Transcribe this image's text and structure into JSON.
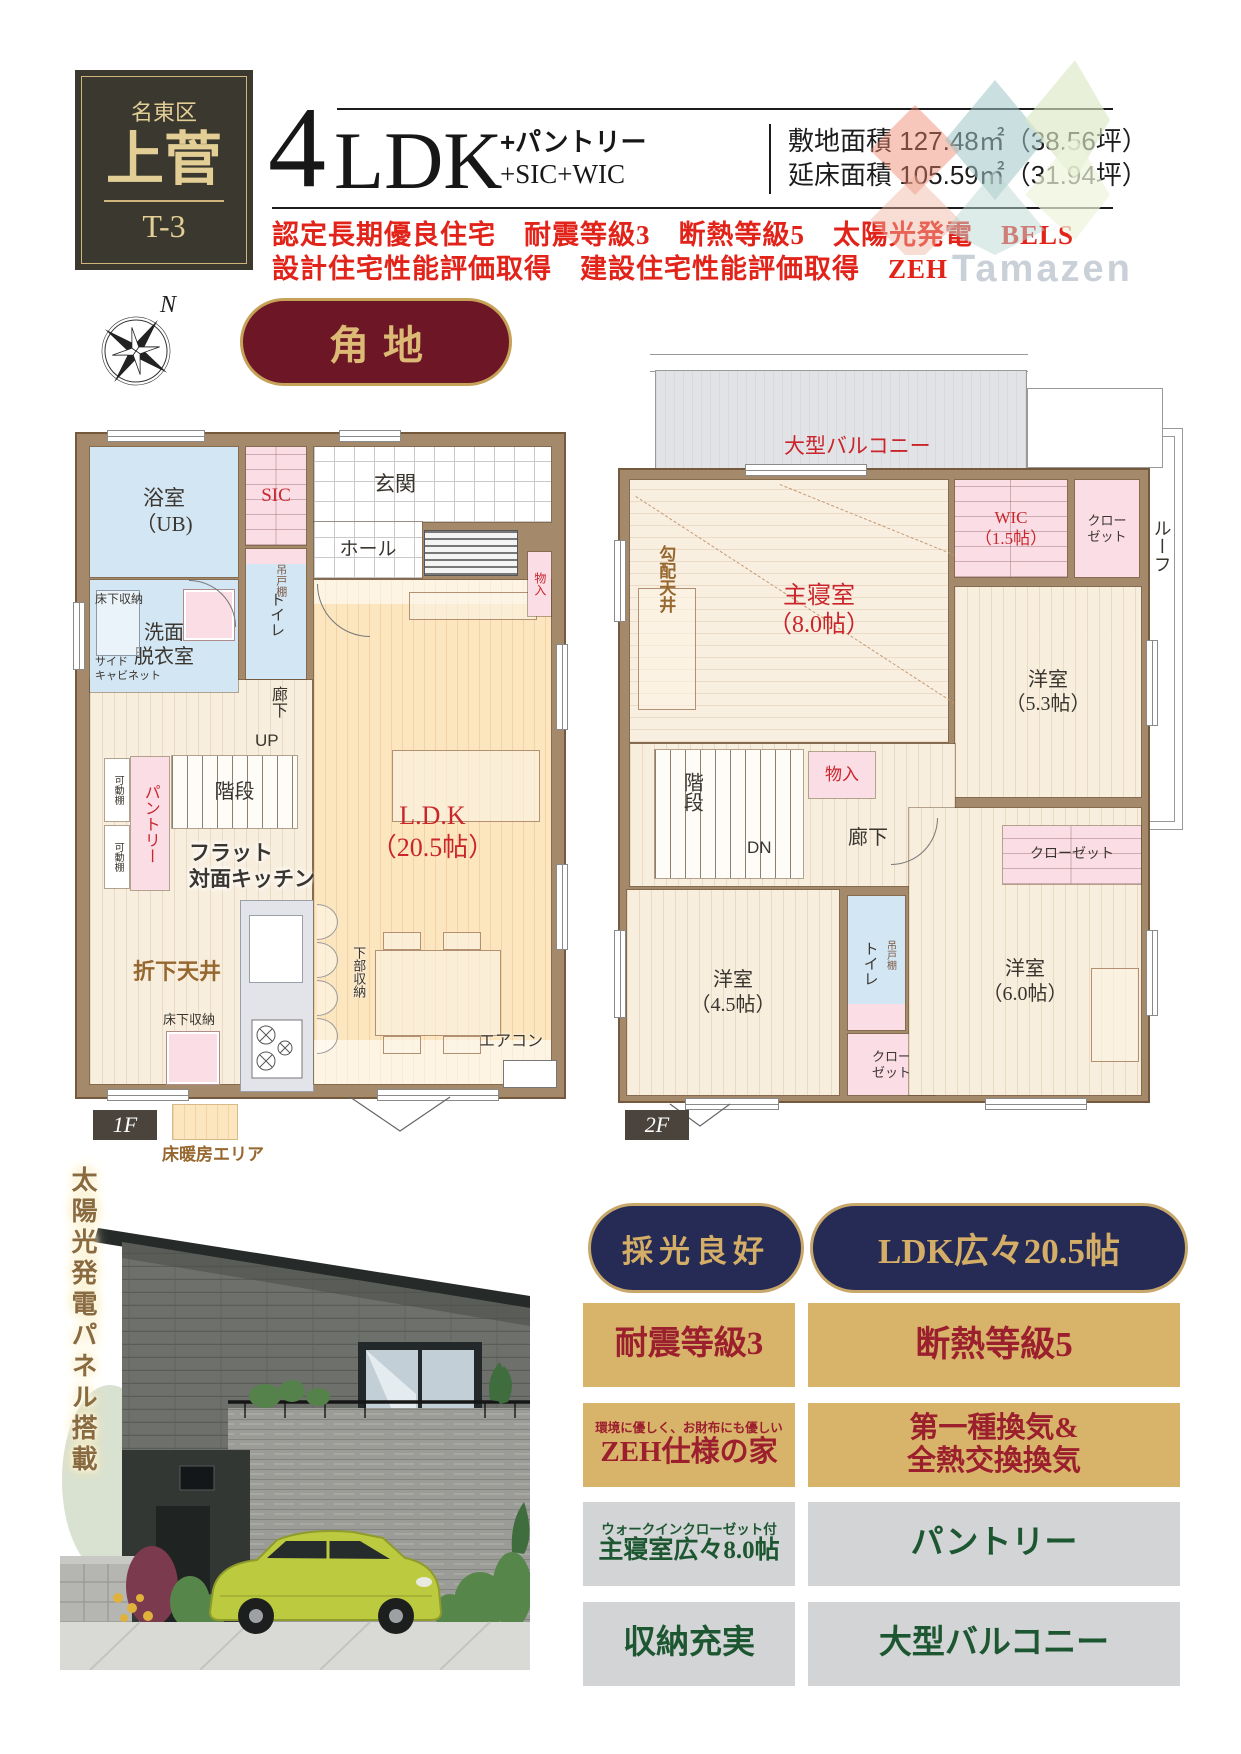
{
  "header": {
    "district": "名東区",
    "name": "上菅",
    "unit": "T-3",
    "ldk_number": "4",
    "ldk_suffix": "LDK",
    "plus1": "+パントリー",
    "plus2": "+SIC+WIC",
    "site_area": "敷地面積 127.48㎡（38.56坪）",
    "floor_area": "延床面積 105.59㎡（31.94坪）",
    "features_line1": "認定長期優良住宅　耐震等級3　断熱等級5　太陽光発電　BELS",
    "features_line2": "設計住宅性能評価取得　建設住宅性能評価取得　ZEH",
    "watermark": "Tamazen"
  },
  "compass": {
    "north": "N"
  },
  "corner_badge": "角地",
  "plan1f": {
    "floor_tag": "1F",
    "legend": "床暖房エリア",
    "bath": "浴室\n（UB)",
    "sic": "SIC",
    "genkan": "玄関",
    "hall": "ホール",
    "yukashita_a": "床下収納",
    "senmen": "洗面\n脱衣室",
    "side_cabinet": "サイド\nキャビネット",
    "toilet": "トイレ",
    "tsuridana": "吊戸棚",
    "rouka": "廊下",
    "up": "UP",
    "kaidan": "階段",
    "kadou_a": "可動棚",
    "kadou_b": "可動棚",
    "pantry": "パントリー",
    "flat_kitchen": "フラット\n対面キッチン",
    "orishita": "折下天井",
    "yukashita_b": "床下収納",
    "kabu": "下部収納",
    "ldk": "L.D.K\n（20.5帖）",
    "monoire": "物入",
    "aircon": "エアコン"
  },
  "plan2f": {
    "floor_tag": "2F",
    "balcony": "大型バルコニー",
    "shinshitsu": "主寝室\n（8.0帖）",
    "kobai": "勾配天井",
    "wic": "WIC\n（1.5帖）",
    "closet_a": "クロー\nゼット",
    "roof": "ルーフ",
    "yo53": "洋室\n（5.3帖）",
    "kaidan": "階段",
    "dn": "DN",
    "monoire": "物入",
    "rouka": "廊下",
    "closet_b": "クローゼット",
    "yo45": "洋室\n（4.5帖）",
    "toilet": "トイレ",
    "tsuridana": "吊戸棚",
    "closet_c": "クロー\nゼット",
    "yo60": "洋室\n（6.0帖）"
  },
  "photo": {
    "caption": "太陽光発電パネル搭載"
  },
  "features": {
    "pill1": "採光良好",
    "pill2": "LDK広々20.5帖",
    "gold1": "耐震等級3",
    "gold2": "断熱等級5",
    "gold3_sub": "環境に優しく、お財布にも優しい",
    "gold3": "ZEH仕様の家",
    "gold4": "第一種換気&\n全熱交換換気",
    "gray1_sub": "ウォークインクローゼット付",
    "gray1": "主寝室広々8.0帖",
    "gray2": "パントリー",
    "gray3": "収納充実",
    "gray4": "大型バルコニー"
  },
  "colors": {
    "maroon": "#6d1626",
    "navy": "#262b55",
    "gold": "#d7b46a",
    "red_accent": "#e2231a",
    "wall_brown": "#a5896b"
  }
}
